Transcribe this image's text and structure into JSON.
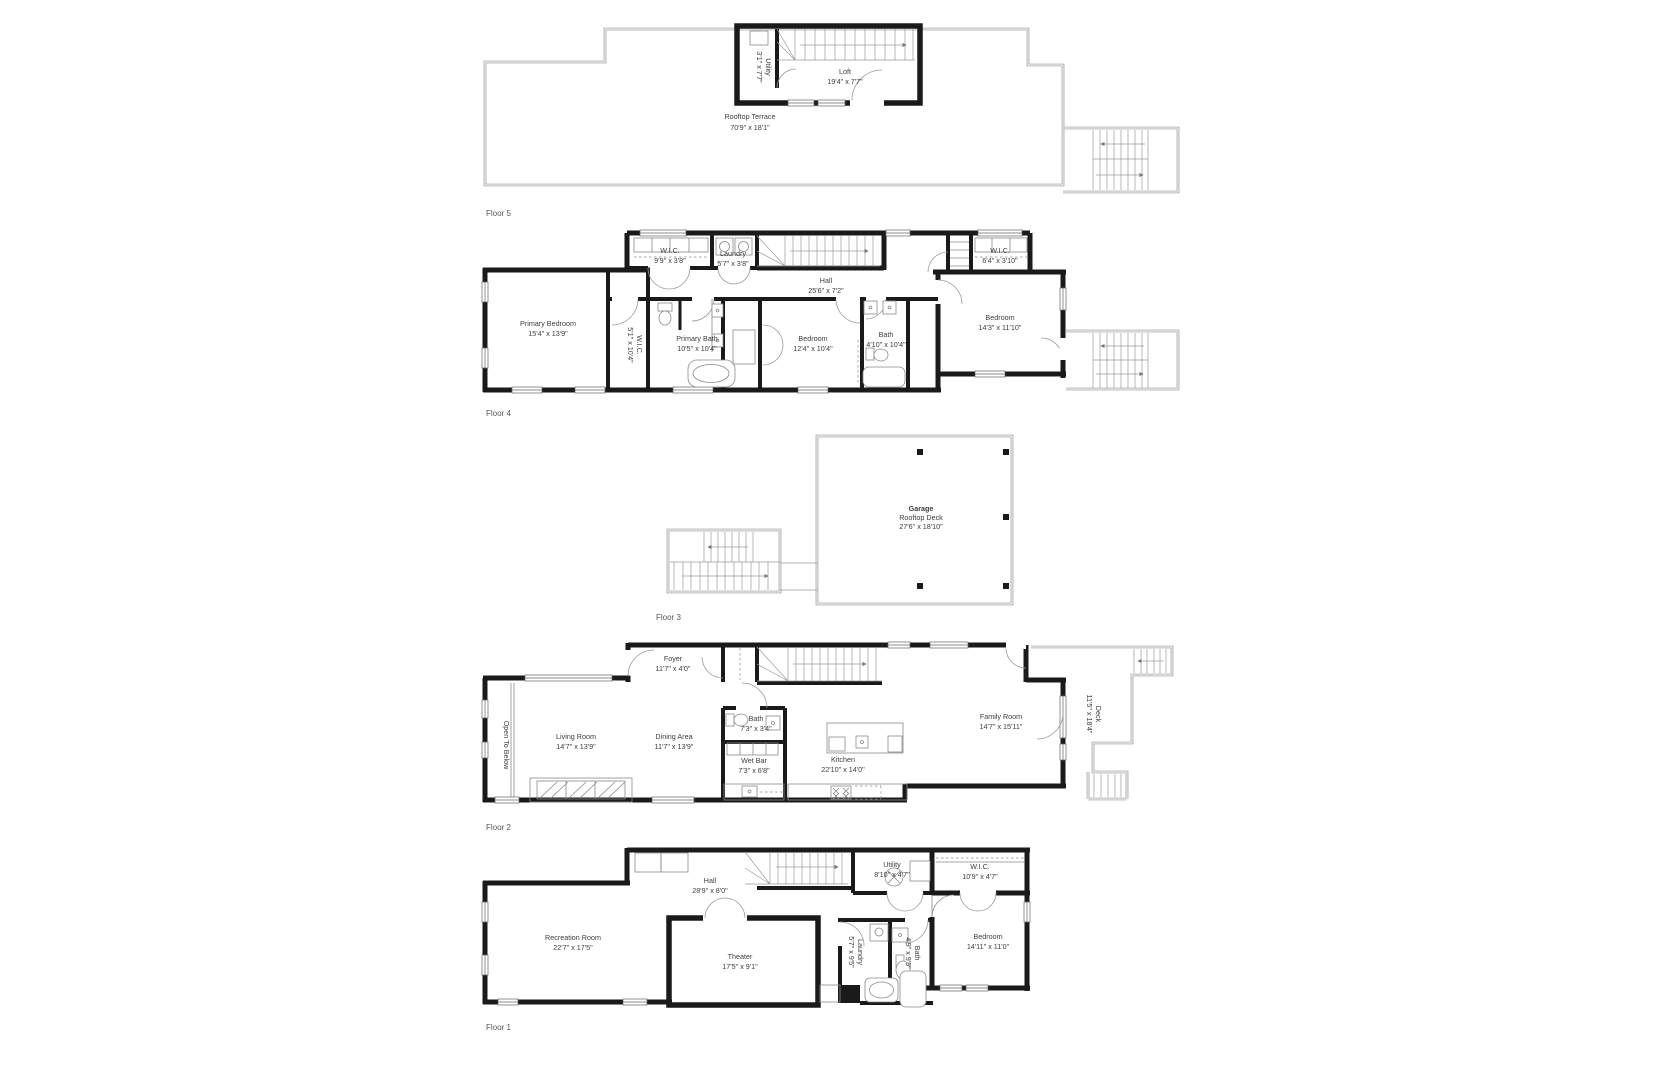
{
  "colors": {
    "wall": "#1a1a1a",
    "outline": "#8c8c8c",
    "text": "#3d3d3d",
    "floor_label": "#555555",
    "background": "#ffffff"
  },
  "floors": [
    {
      "label": "Floor 5",
      "rooms": [
        {
          "name": "Utility",
          "dims": "3'1\" x 7'7\""
        },
        {
          "name": "Loft",
          "dims": "19'4\" x 7'7\""
        },
        {
          "name": "Rooftop Terrace",
          "dims": "70'9\" x 18'1\""
        }
      ]
    },
    {
      "label": "Floor 4",
      "rooms": [
        {
          "name": "W.I.C.",
          "dims": "9'9\" x 3'8\""
        },
        {
          "name": "Laundry",
          "dims": "5'7\" x 3'8\""
        },
        {
          "name": "Hall",
          "dims": "25'6\" x 7'2\""
        },
        {
          "name": "W.I.C.",
          "dims": "6'4\" x 3'10\""
        },
        {
          "name": "Primary Bedroom",
          "dims": "15'4\" x 13'9\""
        },
        {
          "name": "W.I.C.",
          "dims": "5'1\" x 10'4\""
        },
        {
          "name": "Primary Bath",
          "dims": "10'5\" x 10'4\""
        },
        {
          "name": "Bedroom",
          "dims": "12'4\" x 10'4\""
        },
        {
          "name": "Bath",
          "dims": "4'10\" x 10'4\""
        },
        {
          "name": "Bedroom",
          "dims": "14'3\" x 11'10\""
        }
      ]
    },
    {
      "label": "Floor 3",
      "rooms": [
        {
          "name": "Garage",
          "sub": "Rooftop Deck",
          "dims": "27'6\" x 18'10\""
        }
      ]
    },
    {
      "label": "Floor 2",
      "rooms": [
        {
          "name": "Foyer",
          "dims": "11'7\" x 4'0\""
        },
        {
          "name": "Open To Below",
          "dims": ""
        },
        {
          "name": "Living Room",
          "dims": "14'7\" x 13'9\""
        },
        {
          "name": "Dining Area",
          "dims": "11'7\" x 13'9\""
        },
        {
          "name": "Bath",
          "dims": "7'3\" x 3'4\""
        },
        {
          "name": "Wet Bar",
          "dims": "7'3\" x 6'8\""
        },
        {
          "name": "Kitchen",
          "dims": "22'10\" x 14'0\""
        },
        {
          "name": "Family Room",
          "dims": "14'7\" x 15'11\""
        },
        {
          "name": "Deck",
          "dims": "11'5\" x 18'4\""
        }
      ]
    },
    {
      "label": "Floor 1",
      "rooms": [
        {
          "name": "Hall",
          "dims": "28'9\" x 8'0\""
        },
        {
          "name": "Utility",
          "dims": "8'10\" x 4'7\""
        },
        {
          "name": "W.I.C.",
          "dims": "10'9\" x 4'7\""
        },
        {
          "name": "Recreation Room",
          "dims": "22'7\" x 17'5\""
        },
        {
          "name": "Theater",
          "dims": "17'5\" x 9'1\""
        },
        {
          "name": "Laundry",
          "dims": "5'7\" x 9'5\""
        },
        {
          "name": "Bath",
          "dims": "4'9\" x 9'5\""
        },
        {
          "name": "Bedroom",
          "dims": "14'11\" x 11'0\""
        }
      ]
    }
  ]
}
